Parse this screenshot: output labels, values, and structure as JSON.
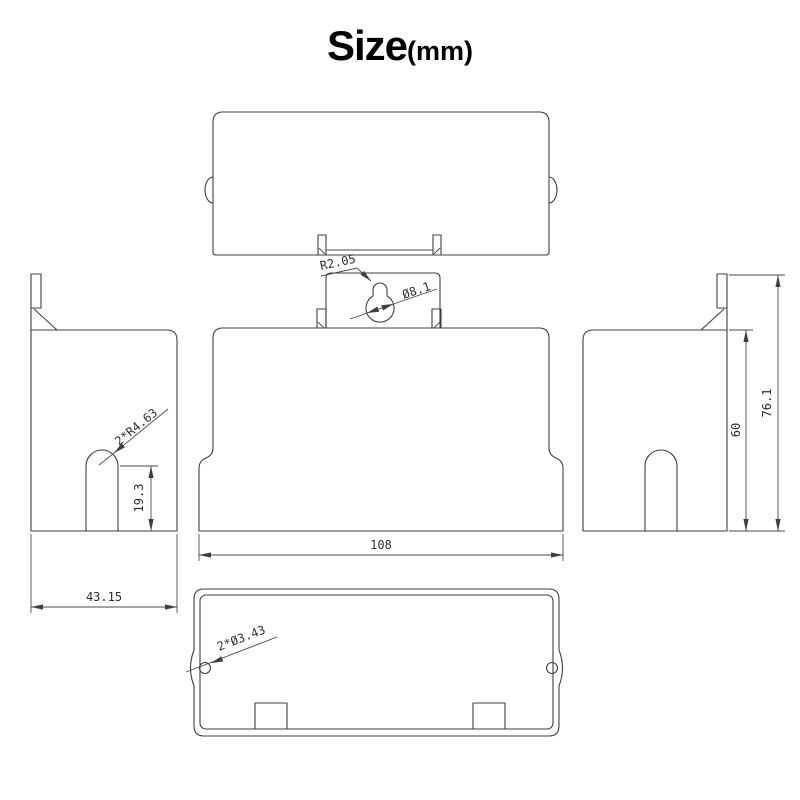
{
  "title": {
    "main": "Size",
    "unit": "(mm)"
  },
  "colors": {
    "line": "#3f3f3f",
    "text": "#2f2f2f",
    "background": "#ffffff"
  },
  "dims": {
    "keyhole_slot_radius": "R2.05",
    "keyhole_hole_diameter": "Ø8.1",
    "front_body_width": "108",
    "side_slot_radius": "2*R4.63",
    "side_slot_height": "19.3",
    "side_body_width": "43.15",
    "body_height": "60",
    "overall_height": "76.1",
    "bottom_hole_diameter": "2*Ø3.43"
  }
}
